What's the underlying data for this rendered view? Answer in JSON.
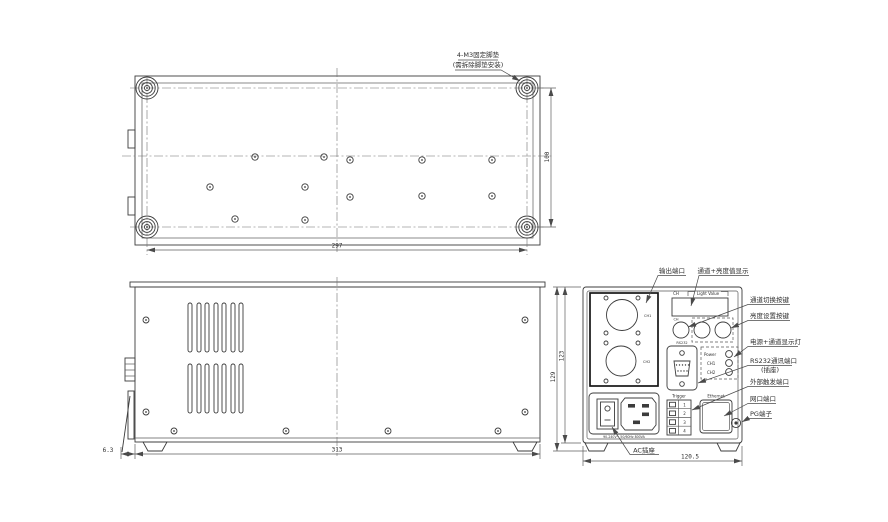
{
  "note": {
    "line1": "4-M3固定脚垫",
    "line2": "(需拆除脚垫安装)"
  },
  "top_view": {
    "dim_width": "297",
    "dim_depth": "100"
  },
  "side_view": {
    "dim_width": "313",
    "dim_foot_offset": "6.3"
  },
  "rear_view": {
    "dim_width": "120.5",
    "dim_height_outer": "129",
    "dim_height_inner": "123",
    "ch1_label": "CH1",
    "ch2_label": "CH2",
    "display_ch_label": "CH",
    "display_value_label": "Light Value",
    "button_ch_label": "CH",
    "rs232_label": "RS232",
    "led_labels": {
      "power": "Power",
      "ch1": "CH1",
      "ch2": "CH2"
    },
    "trigger_label": "Trigger",
    "trigger_pins": [
      "1",
      "2",
      "3",
      "4"
    ],
    "ethernet_label": "Ethernet",
    "ac_rating": "90-240V~ 50/60Hz 800VA"
  },
  "annotations": {
    "output_port": "输出端口",
    "display": "通道+亮度值显示",
    "channel_switch_key": "通道切换按键",
    "brightness_set_key": "亮度设置按键",
    "power_channel_led": "电源+通道显示灯",
    "rs232_port": "RS232通讯端口",
    "rs232_port_sub": "(插座)",
    "external_trigger_port": "外部触发端口",
    "lan_port": "网口端口",
    "pg_terminal": "PG端子",
    "ac_socket": "AC插座"
  }
}
